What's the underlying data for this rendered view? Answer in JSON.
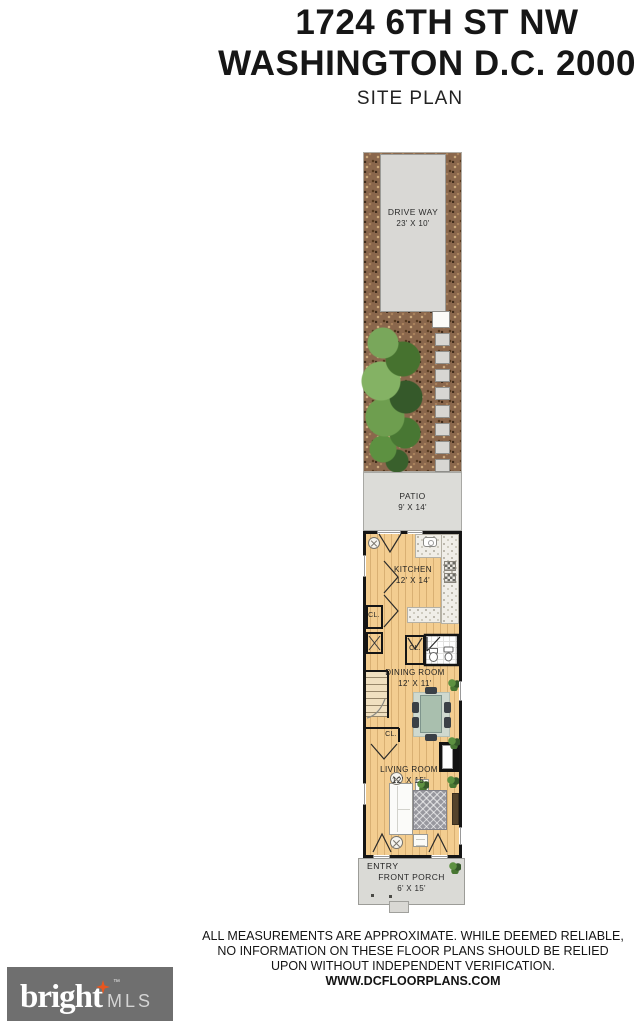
{
  "header": {
    "address_line1": "1724 6TH ST NW",
    "address_line2": "WASHINGTON D.C. 20001",
    "plan_type": "SITE PLAN"
  },
  "plan": {
    "driveway": {
      "label": "DRIVE WAY",
      "dims": "23' X 10'"
    },
    "patio": {
      "label": "PATIO",
      "dims": "9' X 14'"
    },
    "kitchen": {
      "label": "KITCHEN",
      "dims": "12' X 14'"
    },
    "dining_room": {
      "label": "DINING ROOM",
      "dims": "12' X 11'"
    },
    "living_room": {
      "label": "LIVING ROOM",
      "dims": "12' X 15'"
    },
    "entry": {
      "label": "ENTRY"
    },
    "front_porch": {
      "label": "FRONT PORCH",
      "dims": "6' X 15'"
    },
    "closet_abbrev": "CL."
  },
  "footer": {
    "disclaimer_line1": "ALL MEASUREMENTS ARE APPROXIMATE. WHILE DEEMED RELIABLE,",
    "disclaimer_line2": "NO INFORMATION ON THESE FLOOR PLANS SHOULD BE RELIED",
    "disclaimer_line3": "UPON WITHOUT INDEPENDENT VERIFICATION.",
    "website": "WWW.DCFLOORPLANS.COM"
  },
  "logo": {
    "brand": "bright",
    "suffix": "MLS",
    "trademark": "™"
  },
  "colors": {
    "gravel_brown": "#8a674c",
    "hardwood": "#f3cd90",
    "paving_gray": "#d9d8d5",
    "wall_black": "#151515",
    "tree_green": "#5c8f46",
    "logo_background": "#6f6f6f",
    "logo_star_orange": "#e8561e"
  }
}
